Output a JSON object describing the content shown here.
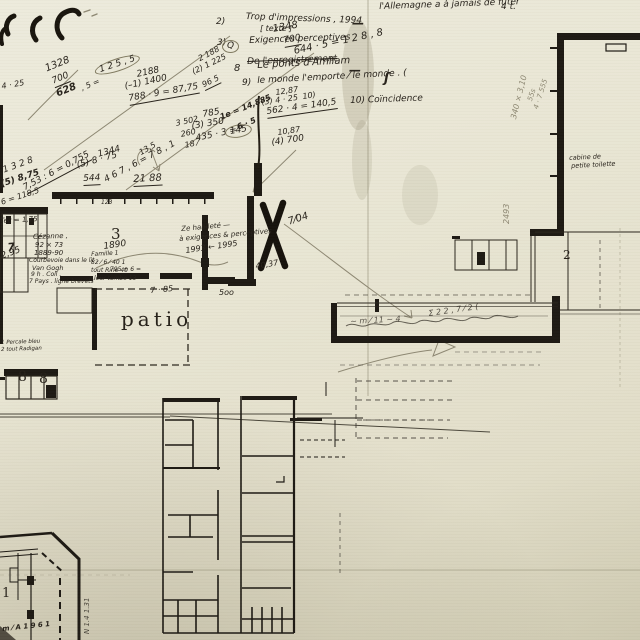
{
  "document": {
    "kind": "Scanned architectural floor plan with handwritten study notes",
    "paper_color": "#e9e6d4",
    "ink_color": "#26211a",
    "pencil_color": "#8d8772",
    "print_color": "#1c1812",
    "plan_features": [
      "top-right gallery building",
      "long corridor",
      "left wing with room 3",
      "patio court",
      "rooms 8-8",
      "bottom service building",
      "chamfered building with room 1",
      "large X correction mark",
      "fold creases and stains"
    ]
  },
  "annotation_groups": [
    {
      "name": "printed-room-label",
      "style": "print",
      "items": [
        {
          "t": "patio",
          "x": 121,
          "y": 309,
          "s": 20,
          "ls": 4
        },
        {
          "t": "8",
          "x": 18,
          "y": 370,
          "s": 14
        },
        {
          "t": "8",
          "x": 39,
          "y": 372,
          "s": 14
        },
        {
          "t": "1",
          "x": 2,
          "y": 587,
          "s": 13
        },
        {
          "t": "2",
          "x": 563,
          "y": 249,
          "s": 12
        },
        {
          "t": "3",
          "x": 111,
          "y": 227,
          "s": 15
        }
      ]
    },
    {
      "name": "list-note",
      "style": "hand",
      "items": [
        {
          "t": "2)",
          "x": 216,
          "y": 18,
          "s": 9
        },
        {
          "t": "Trop d'impressions , 1994",
          "x": 246,
          "y": 13,
          "s": 9,
          "r": 2
        },
        {
          "t": "[ texte ]",
          "x": 260,
          "y": 25,
          "s": 8
        },
        {
          "t": "3)",
          "x": 217,
          "y": 39,
          "s": 9
        },
        {
          "t": "Exigences perceptives",
          "x": 249,
          "y": 37,
          "s": 9,
          "r": -2
        },
        {
          "t": "De l'enregistrement",
          "x": 247,
          "y": 58,
          "s": 9,
          "r": -2,
          "st": 1
        },
        {
          "t": "8",
          "x": 234,
          "y": 64,
          "s": 10
        },
        {
          "t": "Le ponts d'Amliam",
          "x": 257,
          "y": 61,
          "s": 10,
          "r": -3
        },
        {
          "t": "9)",
          "x": 242,
          "y": 79,
          "s": 9
        },
        {
          "t": "le monde l'emporte ⁄ le monde . (",
          "x": 257,
          "y": 77,
          "s": 9,
          "r": -3
        },
        {
          "t": "10) Coïncidence",
          "x": 350,
          "y": 97,
          "s": 9,
          "r": -2
        },
        {
          "t": "l'Allemagne a à jamais de fûter",
          "x": 379,
          "y": 3,
          "s": 9,
          "r": -2
        },
        {
          "t": "4 t.",
          "x": 501,
          "y": 3,
          "s": 9
        },
        {
          "t": "—",
          "x": 352,
          "y": 17,
          "s": 12,
          "w": 700
        },
        {
          "t": "—",
          "x": 349,
          "y": 64,
          "s": 12,
          "w": 700
        },
        {
          "t": "ʃ",
          "x": 384,
          "y": 72,
          "s": 13,
          "w": 700
        }
      ]
    },
    {
      "name": "calculation",
      "style": "hand",
      "items": [
        {
          "t": "1348",
          "x": 272,
          "y": 25,
          "s": 10,
          "r": -10
        },
        {
          "t": "700",
          "x": 283,
          "y": 37,
          "s": 9,
          "r": -10,
          "u": 1
        },
        {
          "t": "644 · 5 = 1 2 8 , 8",
          "x": 293,
          "y": 47,
          "s": 10,
          "r": -12
        },
        {
          "t": "Q",
          "x": 222,
          "y": 40,
          "s": 9,
          "ci": 1
        },
        {
          "t": "1328",
          "x": 44,
          "y": 65,
          "s": 10,
          "r": -22
        },
        {
          "t": "700",
          "x": 51,
          "y": 78,
          "s": 9,
          "r": -22,
          "u": 1
        },
        {
          "t": "628",
          "x": 55,
          "y": 90,
          "s": 10,
          "r": -22,
          "w": 700
        },
        {
          "t": ", 5 =",
          "x": 80,
          "y": 85,
          "s": 8,
          "r": -22
        },
        {
          "t": "1 2 5 , 5",
          "x": 93,
          "y": 66,
          "s": 9,
          "r": -18,
          "ci": 1
        },
        {
          "t": "4 · 25",
          "x": 1,
          "y": 83,
          "s": 8,
          "r": -10
        },
        {
          "t": "1 3 2 8",
          "x": 2,
          "y": 167,
          "s": 9,
          "r": -20
        },
        {
          "t": "(5) 8,75",
          "x": 0,
          "y": 181,
          "s": 9,
          "r": -18,
          "w": 700
        },
        {
          "t": "7,53 : 6 = 0,755",
          "x": 22,
          "y": 185,
          "s": 9,
          "r": -28,
          "u": 1
        },
        {
          "t": "6 = 118,5",
          "x": 0,
          "y": 199,
          "s": 8,
          "r": -18
        },
        {
          "t": "1344",
          "x": 97,
          "y": 151,
          "s": 9,
          "r": -15
        },
        {
          "t": "(5) 8 · 75",
          "x": 76,
          "y": 162,
          "s": 9,
          "r": -15
        },
        {
          "t": "4 6 7 , 6 = 7 8 , 1",
          "x": 103,
          "y": 177,
          "s": 9,
          "r": -28
        },
        {
          "t": "2188",
          "x": 136,
          "y": 71,
          "s": 9,
          "r": -12
        },
        {
          "t": "(–1) 1400",
          "x": 124,
          "y": 83,
          "s": 9,
          "r": -12
        },
        {
          "t": "788 · 9 = 87,75",
          "x": 128,
          "y": 95,
          "s": 9,
          "r": -10,
          "u": 1
        },
        {
          "t": "2 188",
          "x": 197,
          "y": 56,
          "s": 8,
          "r": -28
        },
        {
          "t": "(2) 1 225",
          "x": 191,
          "y": 69,
          "s": 8,
          "r": -26
        },
        {
          "t": "96 5",
          "x": 201,
          "y": 82,
          "s": 8,
          "r": -26,
          "u": 1
        },
        {
          "t": "785",
          "x": 202,
          "y": 111,
          "s": 9,
          "r": -10
        },
        {
          "t": "(3) 350",
          "x": 191,
          "y": 123,
          "s": 9,
          "r": -10
        },
        {
          "t": "435 · 3 =",
          "x": 195,
          "y": 135,
          "s": 9,
          "r": -12
        },
        {
          "t": "145",
          "x": 224,
          "y": 127,
          "s": 9,
          "r": -10,
          "ci": 1
        },
        {
          "t": "3 502",
          "x": 175,
          "y": 120,
          "s": 8,
          "r": -12
        },
        {
          "t": "260",
          "x": 180,
          "y": 131,
          "s": 8,
          "r": -12
        },
        {
          "t": "18 ⁄",
          "x": 184,
          "y": 142,
          "s": 8,
          "r": -12
        },
        {
          "t": "1e = 14,885",
          "x": 219,
          "y": 114,
          "s": 8,
          "r": -22,
          "w": 700
        },
        {
          "t": "6 · 5",
          "x": 236,
          "y": 124,
          "s": 8,
          "r": -22,
          "w": 700
        },
        {
          "t": "12,87",
          "x": 275,
          "y": 89,
          "s": 8,
          "r": -8
        },
        {
          "t": "(3) 4 · 25",
          "x": 261,
          "y": 99,
          "s": 8,
          "r": -8
        },
        {
          "t": "10)",
          "x": 302,
          "y": 93,
          "s": 8,
          "r": -8
        },
        {
          "t": "562 · 4 = 140,5",
          "x": 266,
          "y": 108,
          "s": 9,
          "r": -8,
          "u": 1
        },
        {
          "t": "10,87",
          "x": 277,
          "y": 129,
          "s": 8,
          "r": -8
        },
        {
          "t": "(4) 700",
          "x": 271,
          "y": 139,
          "s": 9,
          "r": -8
        }
      ]
    },
    {
      "name": "dimension-note",
      "style": "hand",
      "items": [
        {
          "t": "544",
          "x": 83,
          "y": 175,
          "s": 9,
          "r": -3,
          "u": 1
        },
        {
          "t": "21 88",
          "x": 133,
          "y": 175,
          "s": 10,
          "r": -3,
          "u": 1
        },
        {
          "t": "123",
          "x": 101,
          "y": 200,
          "s": 6
        },
        {
          "t": "13,5",
          "x": 138,
          "y": 150,
          "s": 8,
          "r": -30
        },
        {
          "t": "7 · 85",
          "x": 150,
          "y": 287,
          "s": 8,
          "r": -5
        },
        {
          "t": "5oo",
          "x": 219,
          "y": 289,
          "s": 8
        },
        {
          "t": "7⁄04",
          "x": 287,
          "y": 218,
          "s": 10,
          "r": -18
        },
        {
          "t": "40,37",
          "x": 255,
          "y": 263,
          "s": 8,
          "r": -10
        },
        {
          "t": "Tec = 1,75",
          "x": 0,
          "y": 218,
          "s": 7,
          "r": -3
        },
        {
          "t": "7",
          "x": 7,
          "y": 242,
          "s": 11,
          "r": -5,
          "w": 700
        },
        {
          "t": "2,95",
          "x": 0,
          "y": 253,
          "s": 9,
          "r": -20
        },
        {
          "t": "1890",
          "x": 103,
          "y": 243,
          "s": 9,
          "r": -8
        },
        {
          "t": "~ m ⁄ 11 ~ 4",
          "x": 350,
          "y": 318,
          "s": 8,
          "r": -3,
          "o": 0.75
        },
        {
          "t": "Σ 2 2 , 7 ⁄ 2 (",
          "x": 428,
          "y": 310,
          "s": 8,
          "r": -8,
          "o": 0.8
        }
      ]
    },
    {
      "name": "margin-scribble",
      "style": "hand",
      "items": [
        {
          "t": "Ze habileté —",
          "x": 181,
          "y": 226,
          "s": 7,
          "r": -5
        },
        {
          "t": "à exigences & perceptives",
          "x": 179,
          "y": 236,
          "s": 7,
          "r": -5
        },
        {
          "t": "1993 ← 1995",
          "x": 185,
          "y": 247,
          "s": 8,
          "r": -8
        },
        {
          "t": "Cézanne ,",
          "x": 33,
          "y": 234,
          "s": 7,
          "r": -2
        },
        {
          "t": "92 × 73",
          "x": 35,
          "y": 242,
          "s": 7
        },
        {
          "t": "1889-90",
          "x": 34,
          "y": 250,
          "s": 7
        },
        {
          "t": "Courbevoie dans le lit .",
          "x": 29,
          "y": 258,
          "s": 6
        },
        {
          "t": "Van Gogh",
          "x": 32,
          "y": 265,
          "s": 6.5
        },
        {
          "t": "9 h . Coll .",
          "x": 31,
          "y": 272,
          "s": 6
        },
        {
          "t": "7 Pays . ligne brevets",
          "x": 29,
          "y": 279,
          "s": 6
        },
        {
          "t": "Famille 1",
          "x": 91,
          "y": 252,
          "s": 6,
          "r": -3
        },
        {
          "t": "82 ⁄ 6 ⁄ 40 1",
          "x": 91,
          "y": 260,
          "s": 6
        },
        {
          "t": "795 + 6 =",
          "x": 110,
          "y": 267,
          "s": 6
        },
        {
          "t": "tout Rine 40",
          "x": 91,
          "y": 268,
          "s": 6
        },
        {
          "t": "leur tombe 13",
          "x": 94,
          "y": 276,
          "s": 6
        },
        {
          "t": "cabine de",
          "x": 569,
          "y": 155,
          "s": 6.5,
          "r": -3
        },
        {
          "t": "petite toilette",
          "x": 571,
          "y": 163,
          "s": 6.5,
          "r": -3
        },
        {
          "t": "1 Percale bleu",
          "x": 1,
          "y": 341,
          "s": 5.5,
          "r": -2
        },
        {
          "t": "2 tout Radigan",
          "x": 1,
          "y": 348,
          "s": 5.5,
          "r": -2
        },
        {
          "t": "m ⁄ A 1 9 6 1",
          "x": 2,
          "y": 626,
          "s": 7,
          "r": -6,
          "w": 700
        }
      ]
    },
    {
      "name": "pencil-dimension",
      "style": "pencil",
      "items": [
        {
          "t": "2493",
          "x": 503,
          "y": 224,
          "s": 8,
          "r": -90
        },
        {
          "t": "340 × 3,10",
          "x": 510,
          "y": 118,
          "s": 8,
          "r": -76
        },
        {
          "t": "55s",
          "x": 527,
          "y": 100,
          "s": 7,
          "r": -72
        },
        {
          "t": "4 · 7 555",
          "x": 533,
          "y": 108,
          "s": 7,
          "r": -72
        }
      ]
    },
    {
      "name": "pencil-dimension-dark",
      "style": "hand",
      "items": [
        {
          "t": "N 1.4 1.31",
          "x": 84,
          "y": 634,
          "s": 7,
          "r": -90,
          "o": 0.8
        }
      ]
    }
  ]
}
